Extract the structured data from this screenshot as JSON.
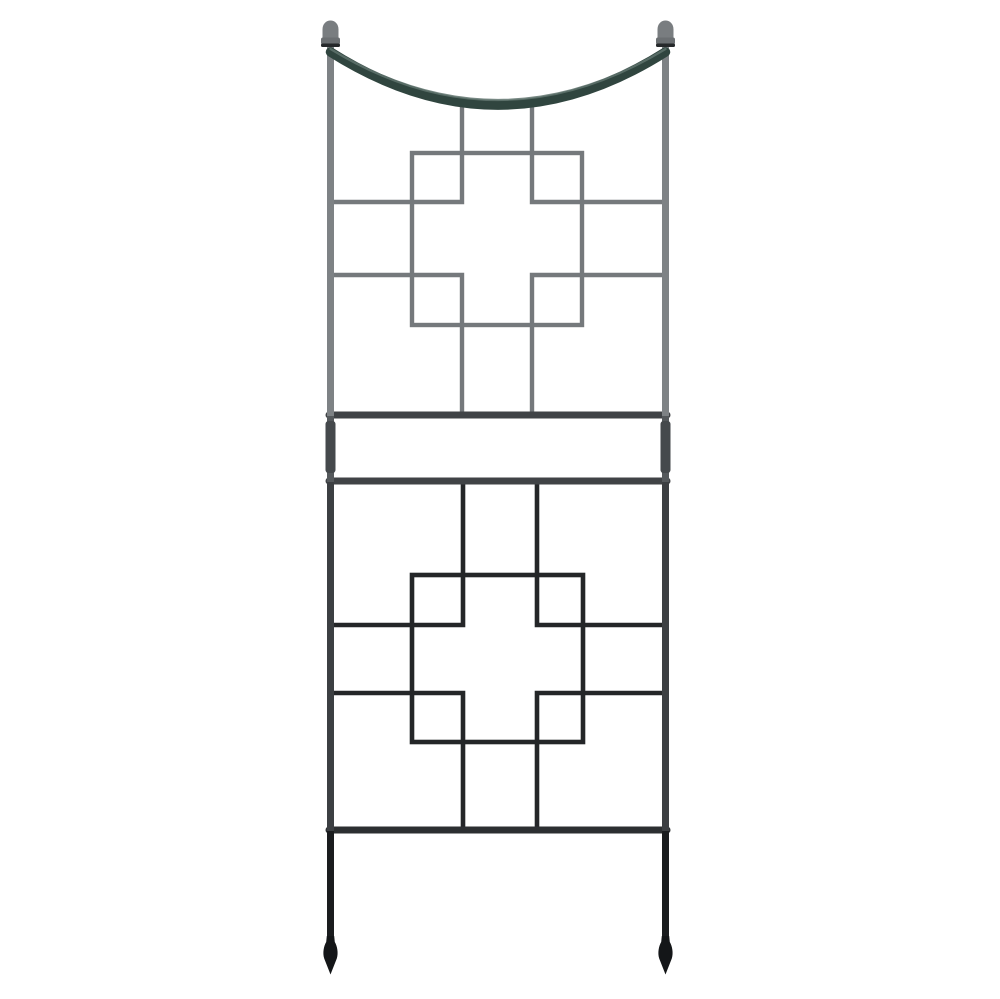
{
  "image": {
    "type": "product-photo",
    "description": "Wrought-iron garden trellis with a sagging arched top bar between two ball finials, two square-and-cross lattice panels joined by ladder rails, post coupling sleeves, and pointed spade feet, photographed on a plain white background",
    "background": "#ffffff"
  },
  "colors": {
    "bg": "#ffffff",
    "wire-upper": "#75797c",
    "wire-lower": "#242628",
    "rail-top": "#404346",
    "rail-bottom": "#2c2f31",
    "arch": "#30453f",
    "arch-highlight": "#5f736d",
    "post-upper": "#7e8285",
    "post-mid": "#55595c",
    "post-lower": "#3c3f42",
    "leg": "#1a1c1e",
    "coupling": "#45494c",
    "finial-ball": "#797d80",
    "finial-cap": "#6b6f72",
    "finial-band": "#26292b",
    "foot": "#141618"
  },
  "parts": {
    "left_finial": "ball finial",
    "right_finial": "ball finial",
    "arch": "curved top bar",
    "left_post": "side post",
    "right_post": "side post",
    "upper_panel": "square-and-cross lattice panel",
    "upper_rail": "cross rail",
    "lower_rail": "cross rail",
    "left_coupling": "coupling sleeve",
    "right_coupling": "coupling sleeve",
    "lower_panel": "square-and-cross lattice panel",
    "bottom_rail": "cross rail",
    "left_foot": "spade foot",
    "right_foot": "spade foot"
  }
}
